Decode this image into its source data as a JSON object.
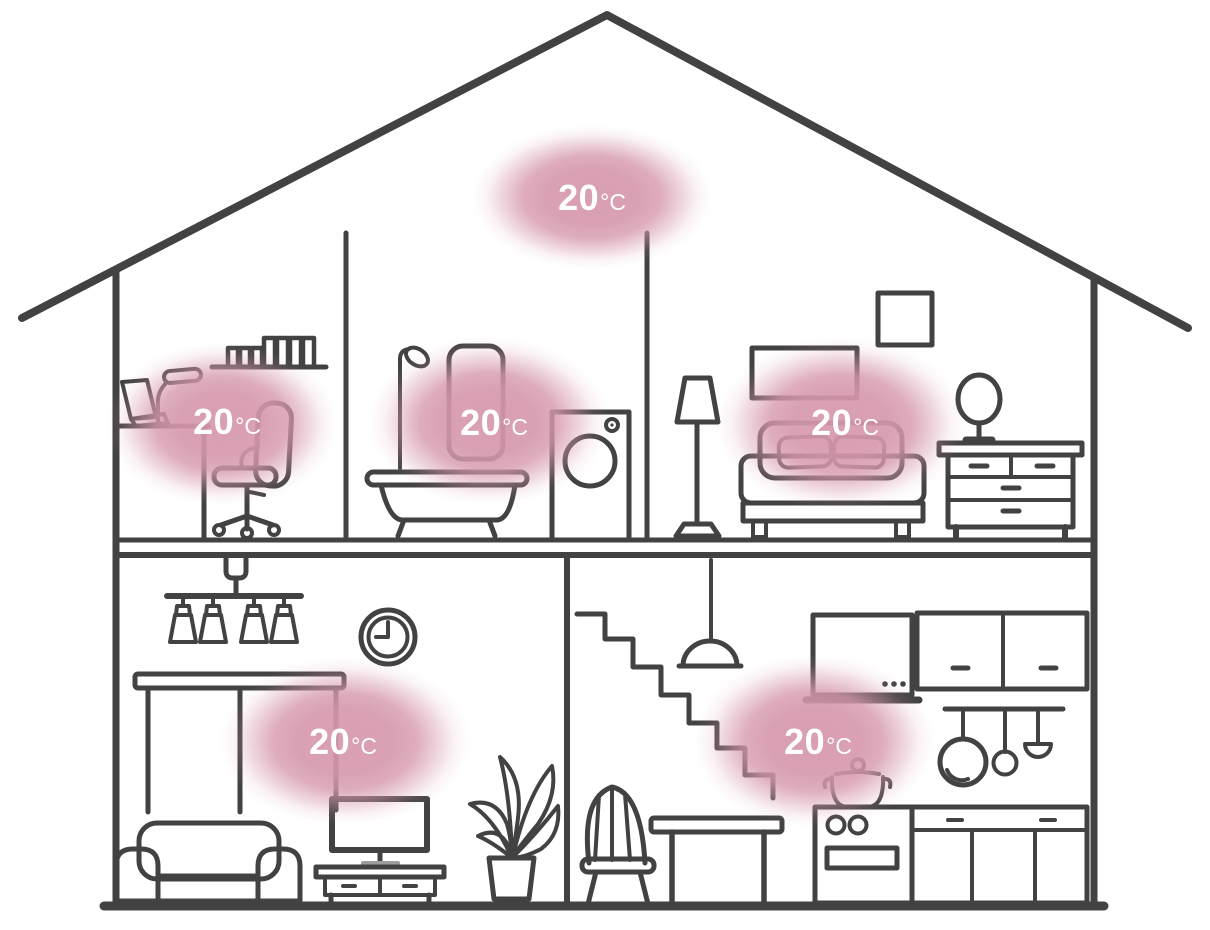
{
  "illustration": {
    "type": "house-cross-section-smart-heating",
    "colors": {
      "line": "#424242",
      "heat_blob_pink": "#d698ae",
      "label_text": "#ffffff"
    }
  },
  "rooms": [
    {
      "id": "attic",
      "temp_value": "20",
      "temp_unit": "°C"
    },
    {
      "id": "office",
      "temp_value": "20",
      "temp_unit": "°C"
    },
    {
      "id": "bathroom",
      "temp_value": "20",
      "temp_unit": "°C"
    },
    {
      "id": "bedroom",
      "temp_value": "20",
      "temp_unit": "°C"
    },
    {
      "id": "living-room",
      "temp_value": "20",
      "temp_unit": "°C"
    },
    {
      "id": "kitchen",
      "temp_value": "20",
      "temp_unit": "°C"
    }
  ]
}
